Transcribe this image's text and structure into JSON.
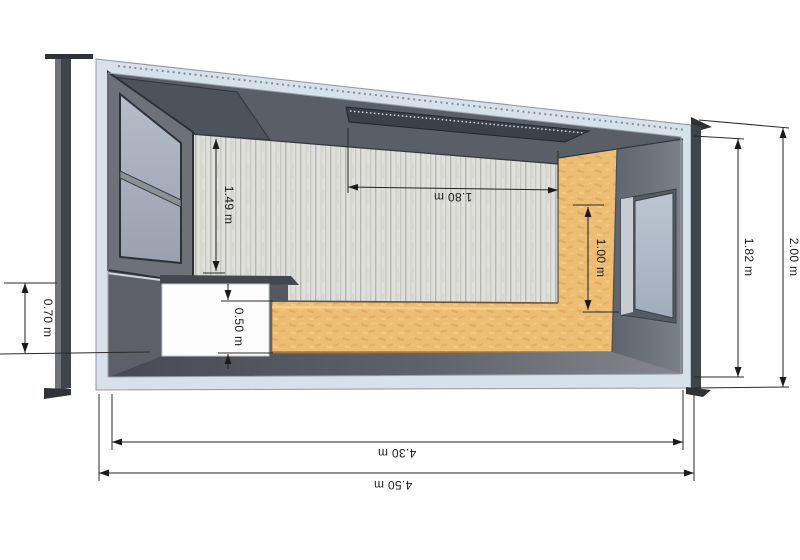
{
  "drawing": {
    "kind": "3d-section-perspective",
    "subject": "container room interior cutaway with dimension annotations",
    "unit": "m"
  },
  "dimensions": {
    "front_sill_height": "0.70 m",
    "upper_wall_height": "1.49 m",
    "ceiling_fixture_span": "1.80 m",
    "panel_height": "1.00 m",
    "bench_height": "0.50 m",
    "interior_height": "1.82 m",
    "exterior_height": "2.00 m",
    "interior_length": "4.30 m",
    "exterior_length": "4.50 m"
  },
  "colors": {
    "shell_band": "#d7e1ea",
    "ceiling_gray": "#5a5f67",
    "ceiling_facet": "#4d535b",
    "fixture_dark": "#3c4148",
    "plank_wall_base": "#dfdfdb",
    "plank_streak": "#b6b6b0",
    "osb_orange": "#ecbd72",
    "osb_fleck": "#dca75c",
    "right_wall": "#6e737b",
    "floor_dark": "#474b51",
    "floor_light": "#85878d",
    "glass_blue": "#a9b1bf",
    "frame_dark": "#34383e",
    "counter_white": "#fdfdfd",
    "counter_top": "#43474e",
    "dimension_ink": "#1b1b1b"
  }
}
